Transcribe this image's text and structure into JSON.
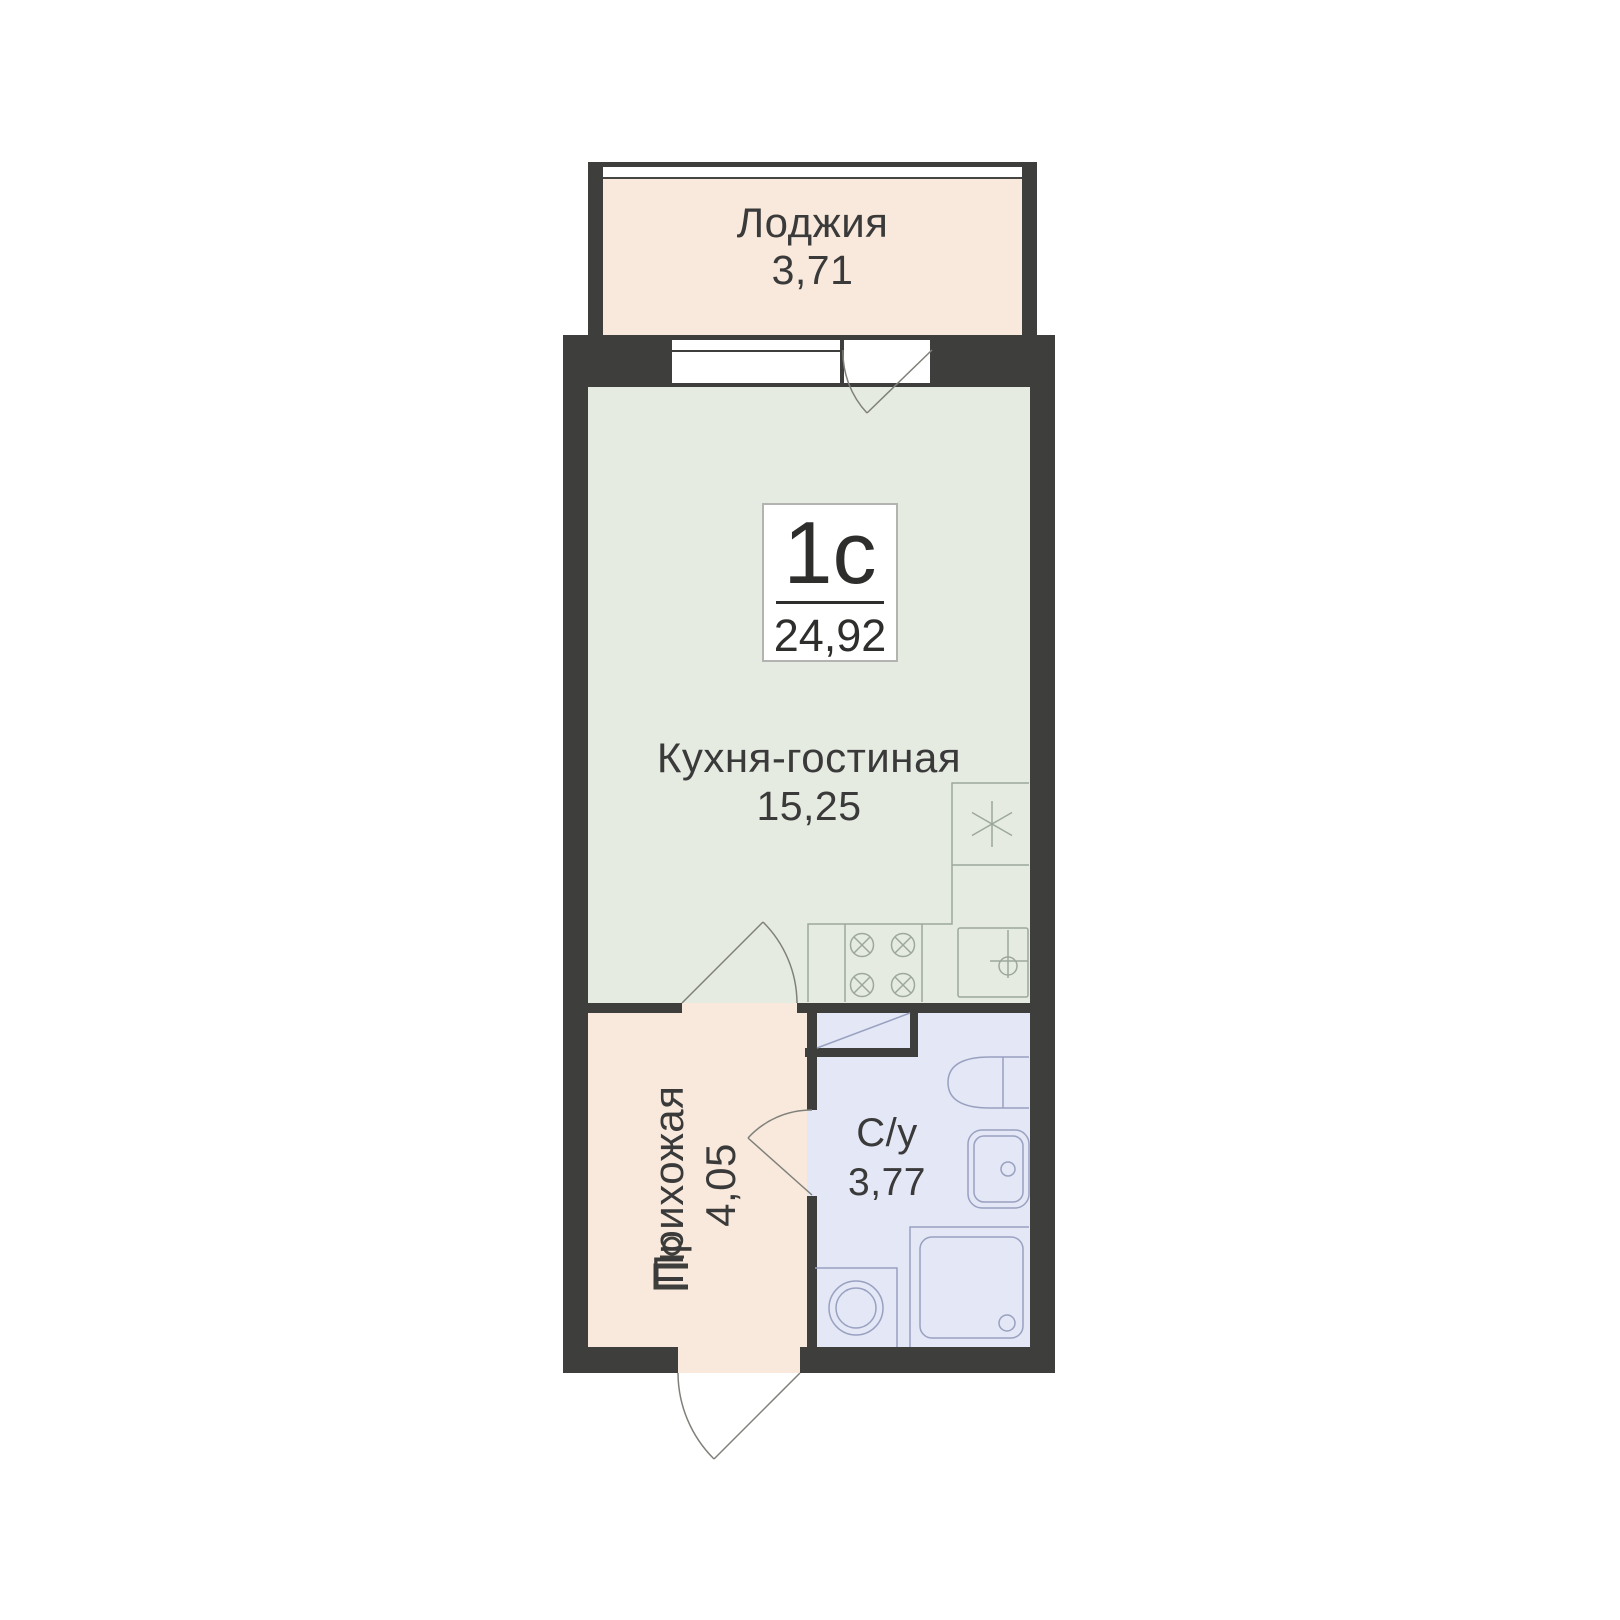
{
  "unit": {
    "label": "1с",
    "area": "24,92"
  },
  "rooms": [
    {
      "name": "Лоджия",
      "area": "3,71"
    },
    {
      "name": "Кухня-гостиная",
      "area": "15,25"
    },
    {
      "name": "Прихожая",
      "area": "4,05"
    },
    {
      "name": "С/у",
      "area": "3,77"
    }
  ],
  "colors": {
    "wall": "#3e3e3c",
    "loggia_fill": "#f8e9dc",
    "kitchen_fill": "#e5ebe1",
    "hallway_fill": "#f8e9dc",
    "bathroom_fill": "#e4e7f5",
    "text": "#3a3a3a",
    "kitchen_fixture_stroke": "#9da79b",
    "bathroom_fixture_stroke": "#99a1c0",
    "door_stroke": "#80807a",
    "unit_box_border": "#b3b3b1"
  },
  "icons": [
    "window-icon",
    "balcony-door-swing-icon",
    "kitchen-sink-icon",
    "stove-icon",
    "sink-cabinet-icon",
    "kitchen-door-swing-icon",
    "vent-duct-icon",
    "toilet-icon",
    "washbasin-icon",
    "shower-icon",
    "washing-machine-icon",
    "bathroom-door-swing-icon",
    "entrance-door-swing-icon",
    "entrance-panel-icon"
  ]
}
